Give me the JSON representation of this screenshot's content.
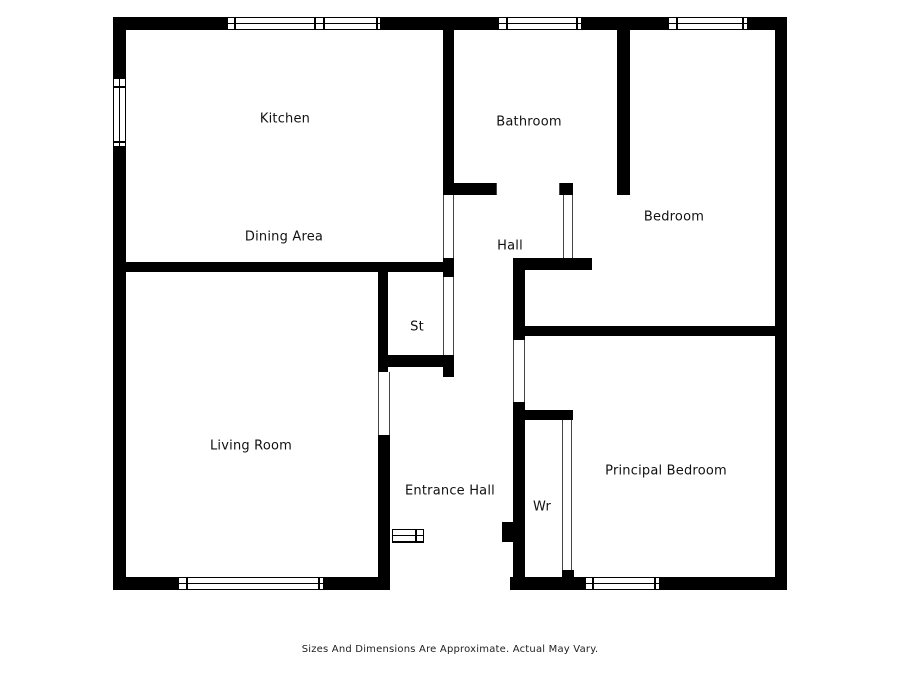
{
  "page": {
    "background": "#ffffff",
    "wall_color": "#000000",
    "disclaimer": "Sizes And Dimensions Are Approximate. Actual May Vary."
  },
  "floorplan": {
    "rooms": [
      {
        "id": "kitchen",
        "label": "Kitchen",
        "cx": 285,
        "cy": 119
      },
      {
        "id": "bathroom",
        "label": "Bathroom",
        "cx": 529,
        "cy": 122
      },
      {
        "id": "bedroom",
        "label": "Bedroom",
        "cx": 674,
        "cy": 217
      },
      {
        "id": "dining-area",
        "label": "Dining Area",
        "cx": 284,
        "cy": 237
      },
      {
        "id": "hall",
        "label": "Hall",
        "cx": 510,
        "cy": 246
      },
      {
        "id": "storage",
        "label": "St",
        "cx": 417,
        "cy": 327
      },
      {
        "id": "living-room",
        "label": "Living Room",
        "cx": 251,
        "cy": 446
      },
      {
        "id": "entrance-hall",
        "label": "Entrance Hall",
        "cx": 450,
        "cy": 491
      },
      {
        "id": "wardrobe",
        "label": "Wr",
        "cx": 542,
        "cy": 507
      },
      {
        "id": "principal-bedroom",
        "label": "Principal Bedroom",
        "cx": 666,
        "cy": 471
      }
    ],
    "walls": [
      {
        "x": 113,
        "y": 17,
        "w": 674,
        "h": 13
      },
      {
        "x": 113,
        "y": 17,
        "w": 13,
        "h": 573
      },
      {
        "x": 775,
        "y": 17,
        "w": 12,
        "h": 573
      },
      {
        "x": 113,
        "y": 577,
        "w": 277,
        "h": 13
      },
      {
        "x": 510,
        "y": 577,
        "w": 277,
        "h": 13
      },
      {
        "x": 443,
        "y": 30,
        "w": 11,
        "h": 165
      },
      {
        "x": 617,
        "y": 30,
        "w": 13,
        "h": 165
      },
      {
        "x": 443,
        "y": 183,
        "w": 53,
        "h": 12
      },
      {
        "x": 560,
        "y": 183,
        "w": 13,
        "h": 12
      },
      {
        "x": 125,
        "y": 262,
        "w": 318,
        "h": 10
      },
      {
        "x": 443,
        "y": 258,
        "w": 11,
        "h": 19
      },
      {
        "x": 378,
        "y": 262,
        "w": 10,
        "h": 110
      },
      {
        "x": 388,
        "y": 355,
        "w": 66,
        "h": 12
      },
      {
        "x": 443,
        "y": 355,
        "w": 11,
        "h": 22
      },
      {
        "x": 513,
        "y": 258,
        "w": 79,
        "h": 12
      },
      {
        "x": 563,
        "y": 255,
        "w": 10,
        "h": 5
      },
      {
        "x": 513,
        "y": 258,
        "w": 12,
        "h": 82
      },
      {
        "x": 513,
        "y": 326,
        "w": 263,
        "h": 10
      },
      {
        "x": 513,
        "y": 402,
        "w": 12,
        "h": 175
      },
      {
        "x": 502,
        "y": 522,
        "w": 21,
        "h": 20
      },
      {
        "x": 522,
        "y": 410,
        "w": 51,
        "h": 10
      },
      {
        "x": 562,
        "y": 570,
        "w": 12,
        "h": 9
      },
      {
        "x": 378,
        "y": 435,
        "w": 12,
        "h": 143
      }
    ],
    "windows": [
      {
        "id": "kitchen-window",
        "x": 227,
        "y": 17,
        "w": 154,
        "h": 13,
        "dir": "h",
        "caps": [
          6,
          86,
          95,
          148
        ]
      },
      {
        "id": "bathroom-window",
        "x": 498,
        "y": 17,
        "w": 84,
        "h": 13,
        "dir": "h",
        "caps": [
          7,
          77
        ]
      },
      {
        "id": "bedroom-window",
        "x": 668,
        "y": 17,
        "w": 80,
        "h": 13,
        "dir": "h",
        "caps": [
          7,
          73
        ]
      },
      {
        "id": "kitchen-side-window",
        "x": 113,
        "y": 78,
        "w": 13,
        "h": 69,
        "dir": "v",
        "caps": [
          7,
          62
        ]
      },
      {
        "id": "living-room-window",
        "x": 178,
        "y": 577,
        "w": 146,
        "h": 13,
        "dir": "h",
        "caps": [
          7,
          139
        ]
      },
      {
        "id": "principal-bedroom-window",
        "x": 585,
        "y": 577,
        "w": 75,
        "h": 13,
        "dir": "h",
        "caps": [
          6,
          68
        ]
      }
    ],
    "openings": [
      {
        "id": "bathroom-door",
        "x": 496,
        "y": 183,
        "w": 64,
        "h": 12
      },
      {
        "id": "hall-door",
        "x": 443,
        "y": 195,
        "w": 11,
        "h": 63
      },
      {
        "id": "bedroom-door",
        "x": 563,
        "y": 195,
        "w": 10,
        "h": 63
      },
      {
        "id": "storage-door",
        "x": 443,
        "y": 277,
        "w": 11,
        "h": 78
      },
      {
        "id": "principal-bedroom-door",
        "x": 513,
        "y": 340,
        "w": 12,
        "h": 62
      },
      {
        "id": "living-room-door",
        "x": 378,
        "y": 372,
        "w": 12,
        "h": 63
      },
      {
        "id": "wardrobe-opening",
        "x": 562,
        "y": 420,
        "w": 10,
        "h": 150
      },
      {
        "id": "front-entrance",
        "x": 390,
        "y": 577,
        "w": 120,
        "h": 13,
        "plain": true
      }
    ],
    "door_symbol": {
      "x": 392,
      "y": 529,
      "w": 32,
      "h": 14,
      "tick": 22
    }
  }
}
